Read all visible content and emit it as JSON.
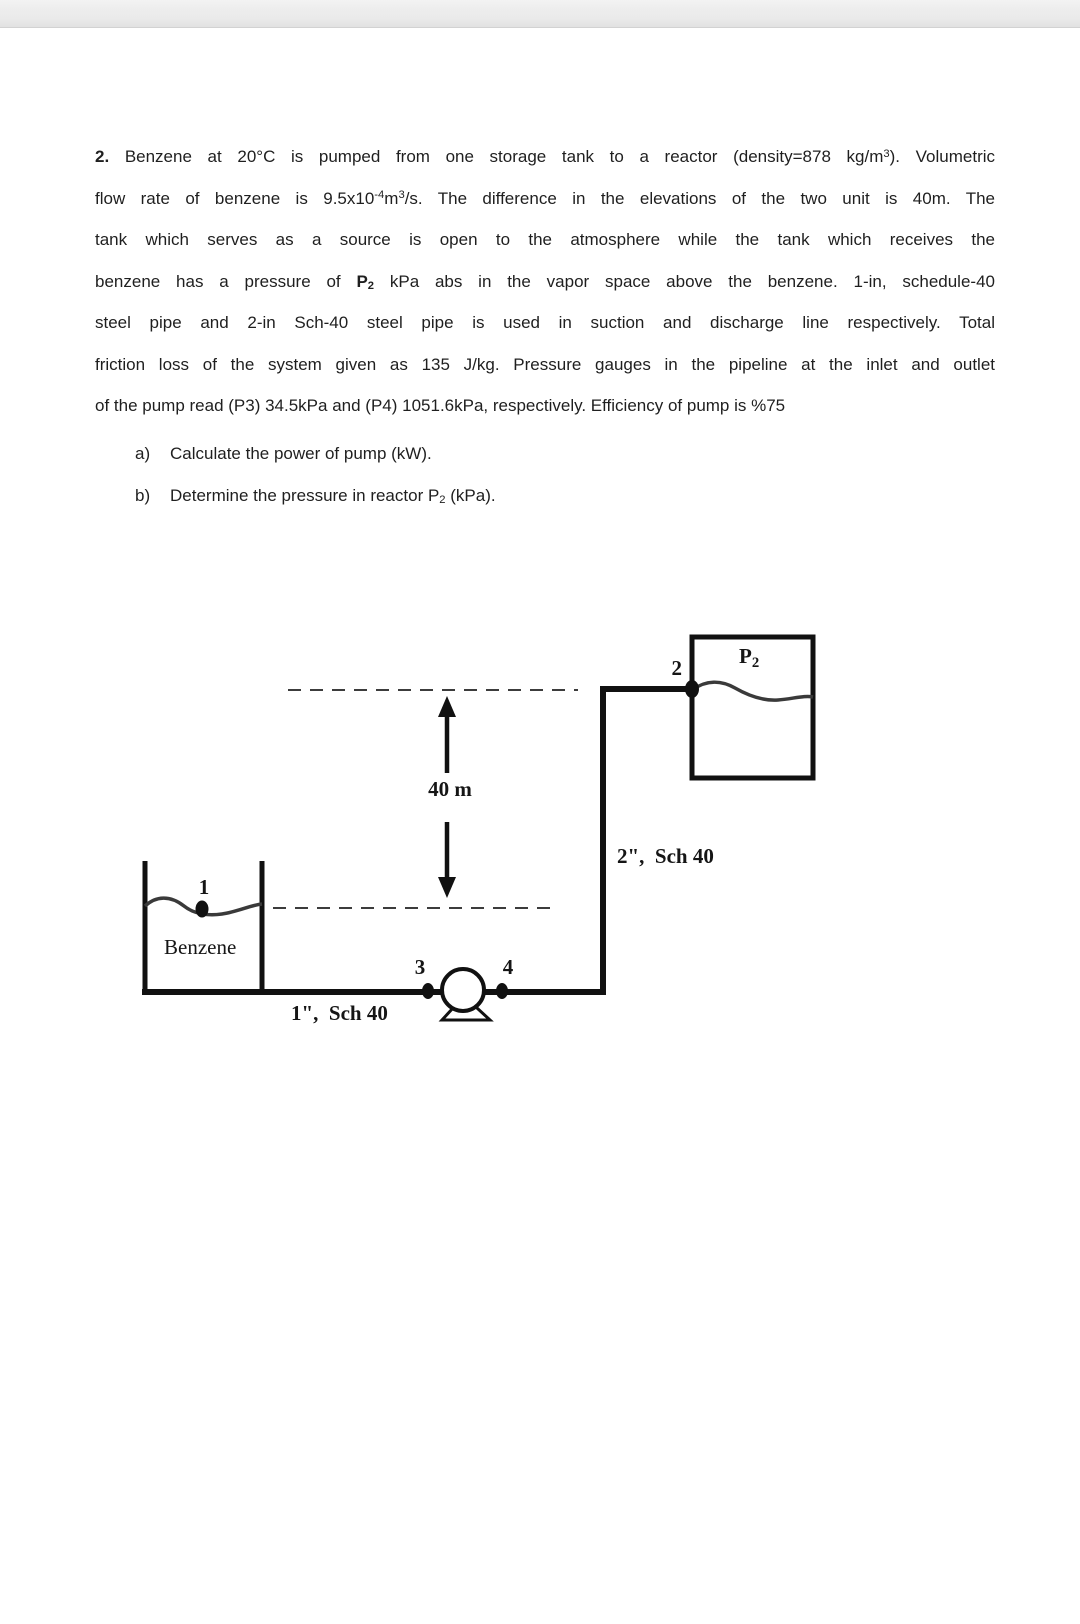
{
  "page": {
    "background": "#ffffff",
    "topbar_color": "#ececec"
  },
  "document": {
    "lines": [
      {
        "justify": true,
        "segments": [
          {
            "t": "2. ",
            "s": "b"
          },
          {
            "t": "Benzene at 20°C is pumped from one storage tank to a reactor (density=878 kg/m"
          },
          {
            "t": "3",
            "s": "sup"
          },
          {
            "t": "). Volumetric"
          }
        ]
      },
      {
        "justify": true,
        "segments": [
          {
            "t": "flow rate of benzene is 9.5x10"
          },
          {
            "t": "-4",
            "s": "sup"
          },
          {
            "t": "m"
          },
          {
            "t": "3",
            "s": "sup"
          },
          {
            "t": "/s.  The difference in the elevations of the two unit is 40m. The"
          }
        ]
      },
      {
        "justify": true,
        "segments": [
          {
            "t": "tank which serves as a source is open to the atmosphere while the tank which receives the"
          }
        ]
      },
      {
        "justify": true,
        "segments": [
          {
            "t": "benzene has a pressure of "
          },
          {
            "t": "P",
            "s": "b"
          },
          {
            "t": "2",
            "s": "bsub"
          },
          {
            "t": " kPa abs in the vapor space above the benzene. 1-in, schedule-40"
          }
        ]
      },
      {
        "justify": true,
        "segments": [
          {
            "t": "steel pipe and 2-in Sch-40 steel pipe is used in suction and discharge line respectively. Total"
          }
        ]
      },
      {
        "justify": true,
        "segments": [
          {
            "t": "friction loss of the system given as 135 J/kg. Pressure gauges in the pipeline at the inlet and outlet"
          }
        ]
      },
      {
        "justify": false,
        "segments": [
          {
            "t": "of the pump read (P3) 34.5kPa and (P4) 1051.6kPa, respectively. Efficiency of pump is %75"
          }
        ]
      }
    ],
    "items": [
      {
        "marker": "a)",
        "segments": [
          {
            "t": "Calculate the power of pump (kW)."
          }
        ]
      },
      {
        "marker": "b)",
        "segments": [
          {
            "t": "Determine the pressure in reactor P"
          },
          {
            "t": "2",
            "s": "sub"
          },
          {
            "t": " (kPa)."
          }
        ]
      }
    ]
  },
  "diagram": {
    "labels": {
      "point2": "2",
      "p2_main": "P",
      "p2_sub": "2",
      "elevation": "40 m",
      "discharge_pipe": "2\",  Sch 40",
      "point1": "1",
      "liquid_name": "Benzene",
      "point3": "3",
      "point4": "4",
      "suction_pipe": "1\",  Sch 40"
    },
    "colors": {
      "line": "#111111",
      "dashed": "#3c3c3c",
      "wave": "#3a3a3a"
    }
  }
}
